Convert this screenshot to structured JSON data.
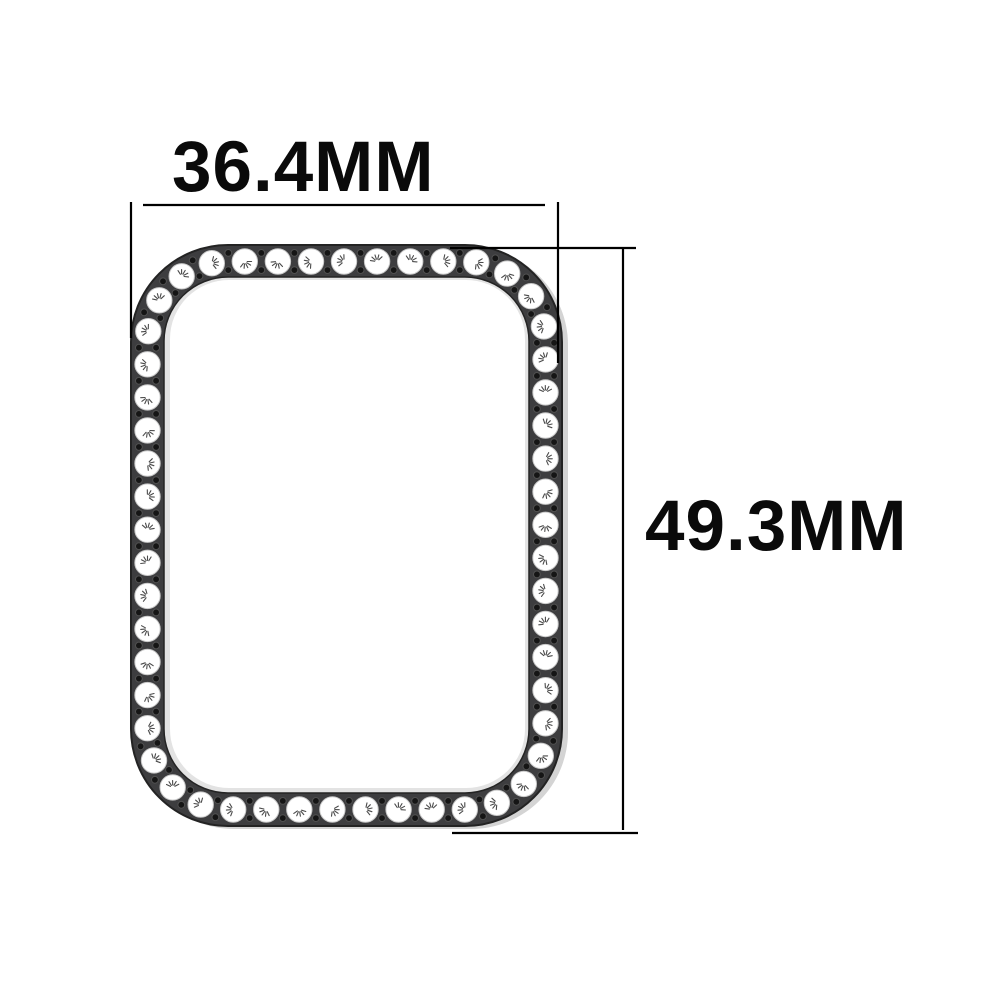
{
  "page": {
    "background": "#ffffff"
  },
  "labels": {
    "width": "36.4MM",
    "height": "49.3MM"
  },
  "bezel": {
    "band_color": "#3d3d3f",
    "band_edge_color": "#232323",
    "inner_lip_color": "#e3e3e3",
    "shadow_color": "#d4d4d4",
    "interior_color": "#ffffff",
    "stone_color": "#ffffff",
    "stone_edge_color": "#c9c9c9",
    "sparkle_color": "#4a4a4a",
    "hole_color": "#151515",
    "hole_ring_color": "#505050",
    "stone_count": 53
  },
  "dimension_lines": {
    "color": "#000000"
  }
}
